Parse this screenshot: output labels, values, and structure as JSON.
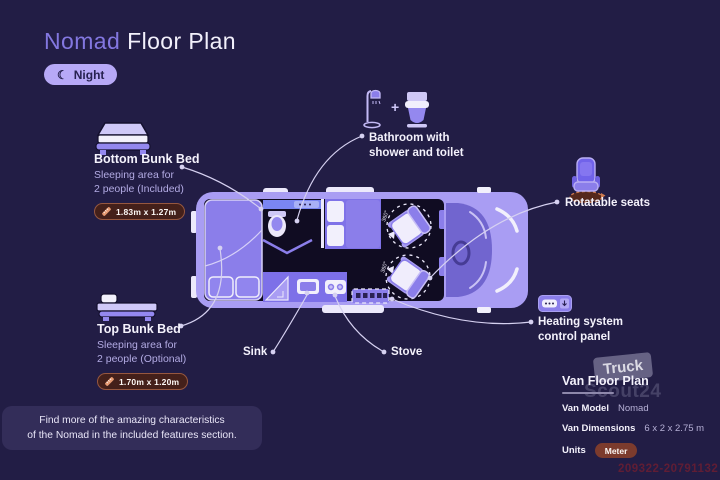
{
  "header": {
    "title_accent": "Nomad",
    "title_rest": "Floor Plan",
    "night_badge": "Night"
  },
  "icons": {
    "moon": "☾",
    "plus": "+"
  },
  "callouts": {
    "bottom_bunk": {
      "title": "Bottom Bunk Bed",
      "desc_line1": "Sleeping area for",
      "desc_line2": "2 people (Included)",
      "dimensions": "1.83m x 1.27m"
    },
    "top_bunk": {
      "title": "Top Bunk Bed",
      "desc_line1": "Sleeping area for",
      "desc_line2": "2 people (Optional)",
      "dimensions": "1.70m x 1.20m"
    },
    "bathroom": {
      "line1": "Bathroom with",
      "line2": "shower and toilet"
    },
    "rotatable_seats": "Rotatable seats",
    "heating": {
      "line1": "Heating system",
      "line2": "control panel"
    },
    "sink": "Sink",
    "stove": "Stove"
  },
  "van": {
    "rotation_marker": "360°"
  },
  "spec_panel": {
    "title": "Van Floor Plan",
    "model_label": "Van Model",
    "model_value": "Nomad",
    "dimensions_label": "Van Dimensions",
    "dimensions_value": "6 x 2 x 2.75 m",
    "units_label": "Units",
    "units_value": "Meter"
  },
  "footer_note": {
    "line1": "Find more of the amazing characteristics",
    "line2": "of the Nomad in the included features section."
  },
  "watermark": {
    "brand_top": "Truck",
    "brand_bottom": "Scout24",
    "listing_id": "209322-20791132"
  },
  "colors": {
    "background": "#221d45",
    "accent_purple": "#8377e0",
    "badge_lilac": "#b7a9f7",
    "van_body": "#a99df3",
    "dim_badge_bg": "#44201a",
    "units_badge_bg": "#7c3b2d"
  }
}
